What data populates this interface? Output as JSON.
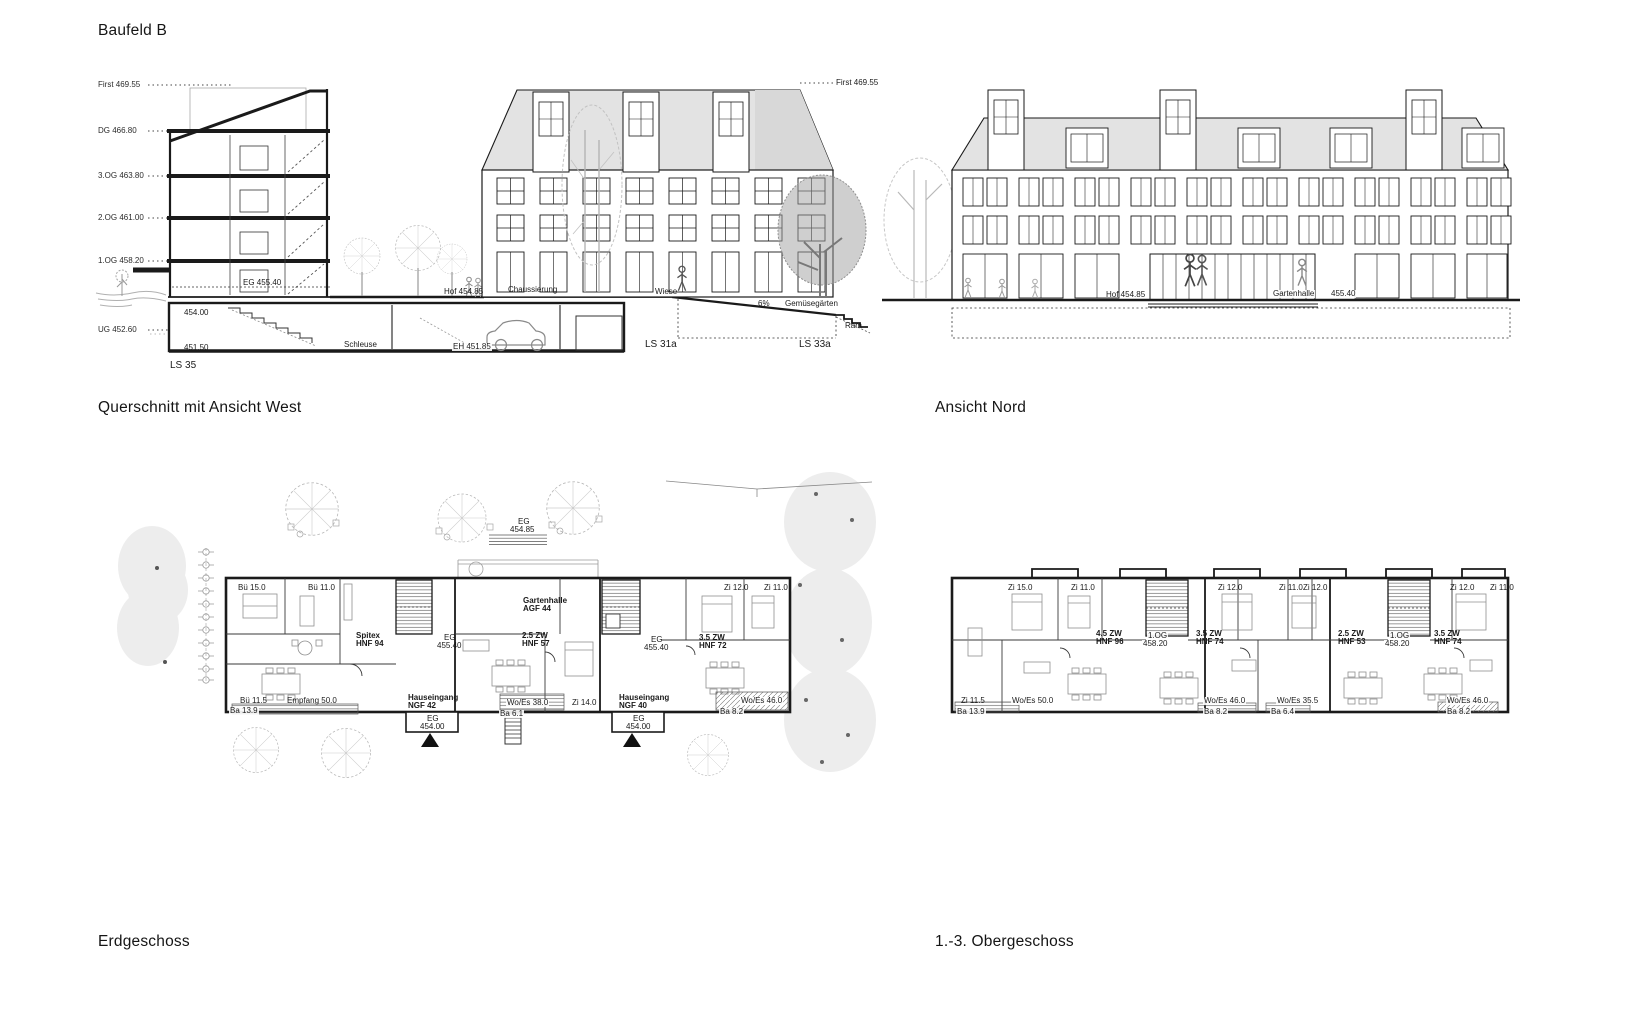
{
  "headings": {
    "sheet_title": "Baufeld B",
    "section_west": "Querschnitt mit Ansicht West",
    "north_elevation": "Ansicht Nord",
    "ground_floor": "Erdgeschoss",
    "upper_floors": "1.-3. Obergeschoss"
  },
  "colors": {
    "line": "#1a1a1a",
    "roof_fill": "#e3e3e3",
    "landscape_fill": "#ededed",
    "light_tree": "#b9b9b9"
  },
  "section_west": {
    "labels": [
      {
        "text": "First 469.55",
        "x": 98,
        "y": 81,
        "s": "lv"
      },
      {
        "text": "DG 466.80",
        "x": 98,
        "y": 127,
        "s": "lv"
      },
      {
        "text": "3.OG 463.80",
        "x": 98,
        "y": 172,
        "s": "lv"
      },
      {
        "text": "2.OG 461.00",
        "x": 98,
        "y": 214,
        "s": "lv"
      },
      {
        "text": "1.OG 458.20",
        "x": 98,
        "y": 257,
        "s": "lv"
      },
      {
        "text": "UG 452.60",
        "x": 98,
        "y": 326,
        "s": "lv"
      },
      {
        "text": "EG 455.40",
        "x": 243,
        "y": 279,
        "s": "an"
      },
      {
        "text": "454.00",
        "x": 184,
        "y": 309,
        "s": "an"
      },
      {
        "text": "451.50",
        "x": 184,
        "y": 344,
        "s": "an"
      },
      {
        "text": "Schleuse",
        "x": 343,
        "y": 341,
        "s": "anb"
      },
      {
        "text": "EH 451.85",
        "x": 452,
        "y": 343,
        "s": "anb"
      },
      {
        "text": "LS 35",
        "x": 170,
        "y": 361,
        "s": "ls"
      },
      {
        "text": "Hof 454.85",
        "x": 444,
        "y": 288,
        "s": "an"
      },
      {
        "text": "Chaussierung",
        "x": 508,
        "y": 286,
        "s": "an"
      },
      {
        "text": "Wiese",
        "x": 655,
        "y": 288,
        "s": "an"
      },
      {
        "text": "6%",
        "x": 758,
        "y": 300,
        "s": "an"
      },
      {
        "text": "Gemüsegärten",
        "x": 784,
        "y": 300,
        "s": "anb"
      },
      {
        "text": "LS 31a",
        "x": 645,
        "y": 340,
        "s": "ls"
      },
      {
        "text": "LS 33a",
        "x": 799,
        "y": 340,
        "s": "ls"
      },
      {
        "text": "Ram",
        "x": 845,
        "y": 322,
        "s": "an"
      },
      {
        "text": "First 469.55",
        "x": 836,
        "y": 79,
        "s": "an"
      }
    ]
  },
  "north_elevation": {
    "labels": [
      {
        "text": "Hof 454.85",
        "x": 1106,
        "y": 291,
        "s": "an"
      },
      {
        "text": "Gartenhalle",
        "x": 1272,
        "y": 290,
        "s": "anb"
      },
      {
        "text": "455.40",
        "x": 1330,
        "y": 290,
        "s": "anb"
      }
    ]
  },
  "ground_floor_plan": {
    "labels": [
      {
        "text": "EG",
        "x": 518,
        "y": 518,
        "s": "an"
      },
      {
        "text": "454.85",
        "x": 510,
        "y": 526,
        "s": "an"
      },
      {
        "text": "Bü 15.0",
        "x": 238,
        "y": 584,
        "s": "an"
      },
      {
        "text": "Bü 11.0",
        "x": 308,
        "y": 584,
        "s": "an"
      },
      {
        "text": "Zi 12.0",
        "x": 724,
        "y": 584,
        "s": "an"
      },
      {
        "text": "Zi 11.0",
        "x": 764,
        "y": 584,
        "s": "an"
      },
      {
        "text": "Gartenhalle",
        "x": 523,
        "y": 597,
        "s": "bd"
      },
      {
        "text": "AGF 44",
        "x": 523,
        "y": 605,
        "s": "bd"
      },
      {
        "text": "Spitex",
        "x": 356,
        "y": 632,
        "s": "bd"
      },
      {
        "text": "HNF 94",
        "x": 356,
        "y": 640,
        "s": "bd"
      },
      {
        "text": "EG",
        "x": 444,
        "y": 634,
        "s": "an"
      },
      {
        "text": "455.40",
        "x": 437,
        "y": 642,
        "s": "an"
      },
      {
        "text": "2.5 ZW",
        "x": 522,
        "y": 632,
        "s": "bd"
      },
      {
        "text": "HNF 57",
        "x": 522,
        "y": 640,
        "s": "bd"
      },
      {
        "text": "EG",
        "x": 651,
        "y": 636,
        "s": "an"
      },
      {
        "text": "455.40",
        "x": 644,
        "y": 644,
        "s": "an"
      },
      {
        "text": "3.5 ZW",
        "x": 699,
        "y": 634,
        "s": "bd"
      },
      {
        "text": "HNF 72",
        "x": 699,
        "y": 642,
        "s": "bd"
      },
      {
        "text": "Bü 11.5",
        "x": 240,
        "y": 697,
        "s": "an"
      },
      {
        "text": "Empfang 50.0",
        "x": 287,
        "y": 697,
        "s": "an"
      },
      {
        "text": "Hauseingang",
        "x": 408,
        "y": 694,
        "s": "bd"
      },
      {
        "text": "NGF 42",
        "x": 408,
        "y": 702,
        "s": "bd"
      },
      {
        "text": "Wo/Es 38.0",
        "x": 506,
        "y": 699,
        "s": "anb"
      },
      {
        "text": "Hauseingang",
        "x": 619,
        "y": 694,
        "s": "bd"
      },
      {
        "text": "NGF 40",
        "x": 619,
        "y": 702,
        "s": "bd"
      },
      {
        "text": "Wo/Es 46.0",
        "x": 740,
        "y": 697,
        "s": "anb"
      },
      {
        "text": "EG",
        "x": 427,
        "y": 715,
        "s": "an"
      },
      {
        "text": "454.00",
        "x": 420,
        "y": 723,
        "s": "an"
      },
      {
        "text": "EG",
        "x": 633,
        "y": 715,
        "s": "an"
      },
      {
        "text": "454.00",
        "x": 626,
        "y": 723,
        "s": "an"
      },
      {
        "text": "Ba 13.9",
        "x": 229,
        "y": 707,
        "s": "anb"
      },
      {
        "text": "Ba 6.1",
        "x": 499,
        "y": 710,
        "s": "anb"
      },
      {
        "text": "Zi 14.0",
        "x": 571,
        "y": 699,
        "s": "anb"
      },
      {
        "text": "Ba 8.2",
        "x": 719,
        "y": 708,
        "s": "anb"
      }
    ]
  },
  "upper_floor_plan": {
    "labels": [
      {
        "text": "Zi 15.0",
        "x": 1008,
        "y": 584,
        "s": "an"
      },
      {
        "text": "Zi 11.0",
        "x": 1071,
        "y": 584,
        "s": "an"
      },
      {
        "text": "Zi 12.0",
        "x": 1218,
        "y": 584,
        "s": "an"
      },
      {
        "text": "Zi 11.0",
        "x": 1279,
        "y": 584,
        "s": "an"
      },
      {
        "text": "Zi 12.0",
        "x": 1303,
        "y": 584,
        "s": "an"
      },
      {
        "text": "Zi 12.0",
        "x": 1450,
        "y": 584,
        "s": "an"
      },
      {
        "text": "Zi 11.0",
        "x": 1490,
        "y": 584,
        "s": "an"
      },
      {
        "text": "4.5 ZW",
        "x": 1096,
        "y": 630,
        "s": "bd"
      },
      {
        "text": "HNF 96",
        "x": 1096,
        "y": 638,
        "s": "bd"
      },
      {
        "text": "1.OG",
        "x": 1147,
        "y": 632,
        "s": "anb"
      },
      {
        "text": "458.20",
        "x": 1142,
        "y": 640,
        "s": "anb"
      },
      {
        "text": "3.5 ZW",
        "x": 1196,
        "y": 630,
        "s": "bd"
      },
      {
        "text": "HNF 74",
        "x": 1196,
        "y": 638,
        "s": "bd"
      },
      {
        "text": "2.5 ZW",
        "x": 1338,
        "y": 630,
        "s": "bd"
      },
      {
        "text": "HNF 53",
        "x": 1338,
        "y": 638,
        "s": "bd"
      },
      {
        "text": "1.OG",
        "x": 1389,
        "y": 632,
        "s": "anb"
      },
      {
        "text": "458.20",
        "x": 1384,
        "y": 640,
        "s": "anb"
      },
      {
        "text": "3.5 ZW",
        "x": 1434,
        "y": 630,
        "s": "bd"
      },
      {
        "text": "HNF 74",
        "x": 1434,
        "y": 638,
        "s": "bd"
      },
      {
        "text": "Zi 11.5",
        "x": 961,
        "y": 697,
        "s": "an"
      },
      {
        "text": "Wo/Es 50.0",
        "x": 1011,
        "y": 697,
        "s": "anb"
      },
      {
        "text": "Ba 13.9",
        "x": 956,
        "y": 708,
        "s": "anb"
      },
      {
        "text": "Wo/Es 46.0",
        "x": 1203,
        "y": 697,
        "s": "anb"
      },
      {
        "text": "Ba 8.2",
        "x": 1203,
        "y": 708,
        "s": "anb"
      },
      {
        "text": "Ba 6.4",
        "x": 1270,
        "y": 708,
        "s": "anb"
      },
      {
        "text": "Wo/Es 35.5",
        "x": 1276,
        "y": 697,
        "s": "anb"
      },
      {
        "text": "Wo/Es 46.0",
        "x": 1446,
        "y": 697,
        "s": "anb"
      },
      {
        "text": "Ba 8.2",
        "x": 1446,
        "y": 708,
        "s": "anb"
      }
    ]
  }
}
